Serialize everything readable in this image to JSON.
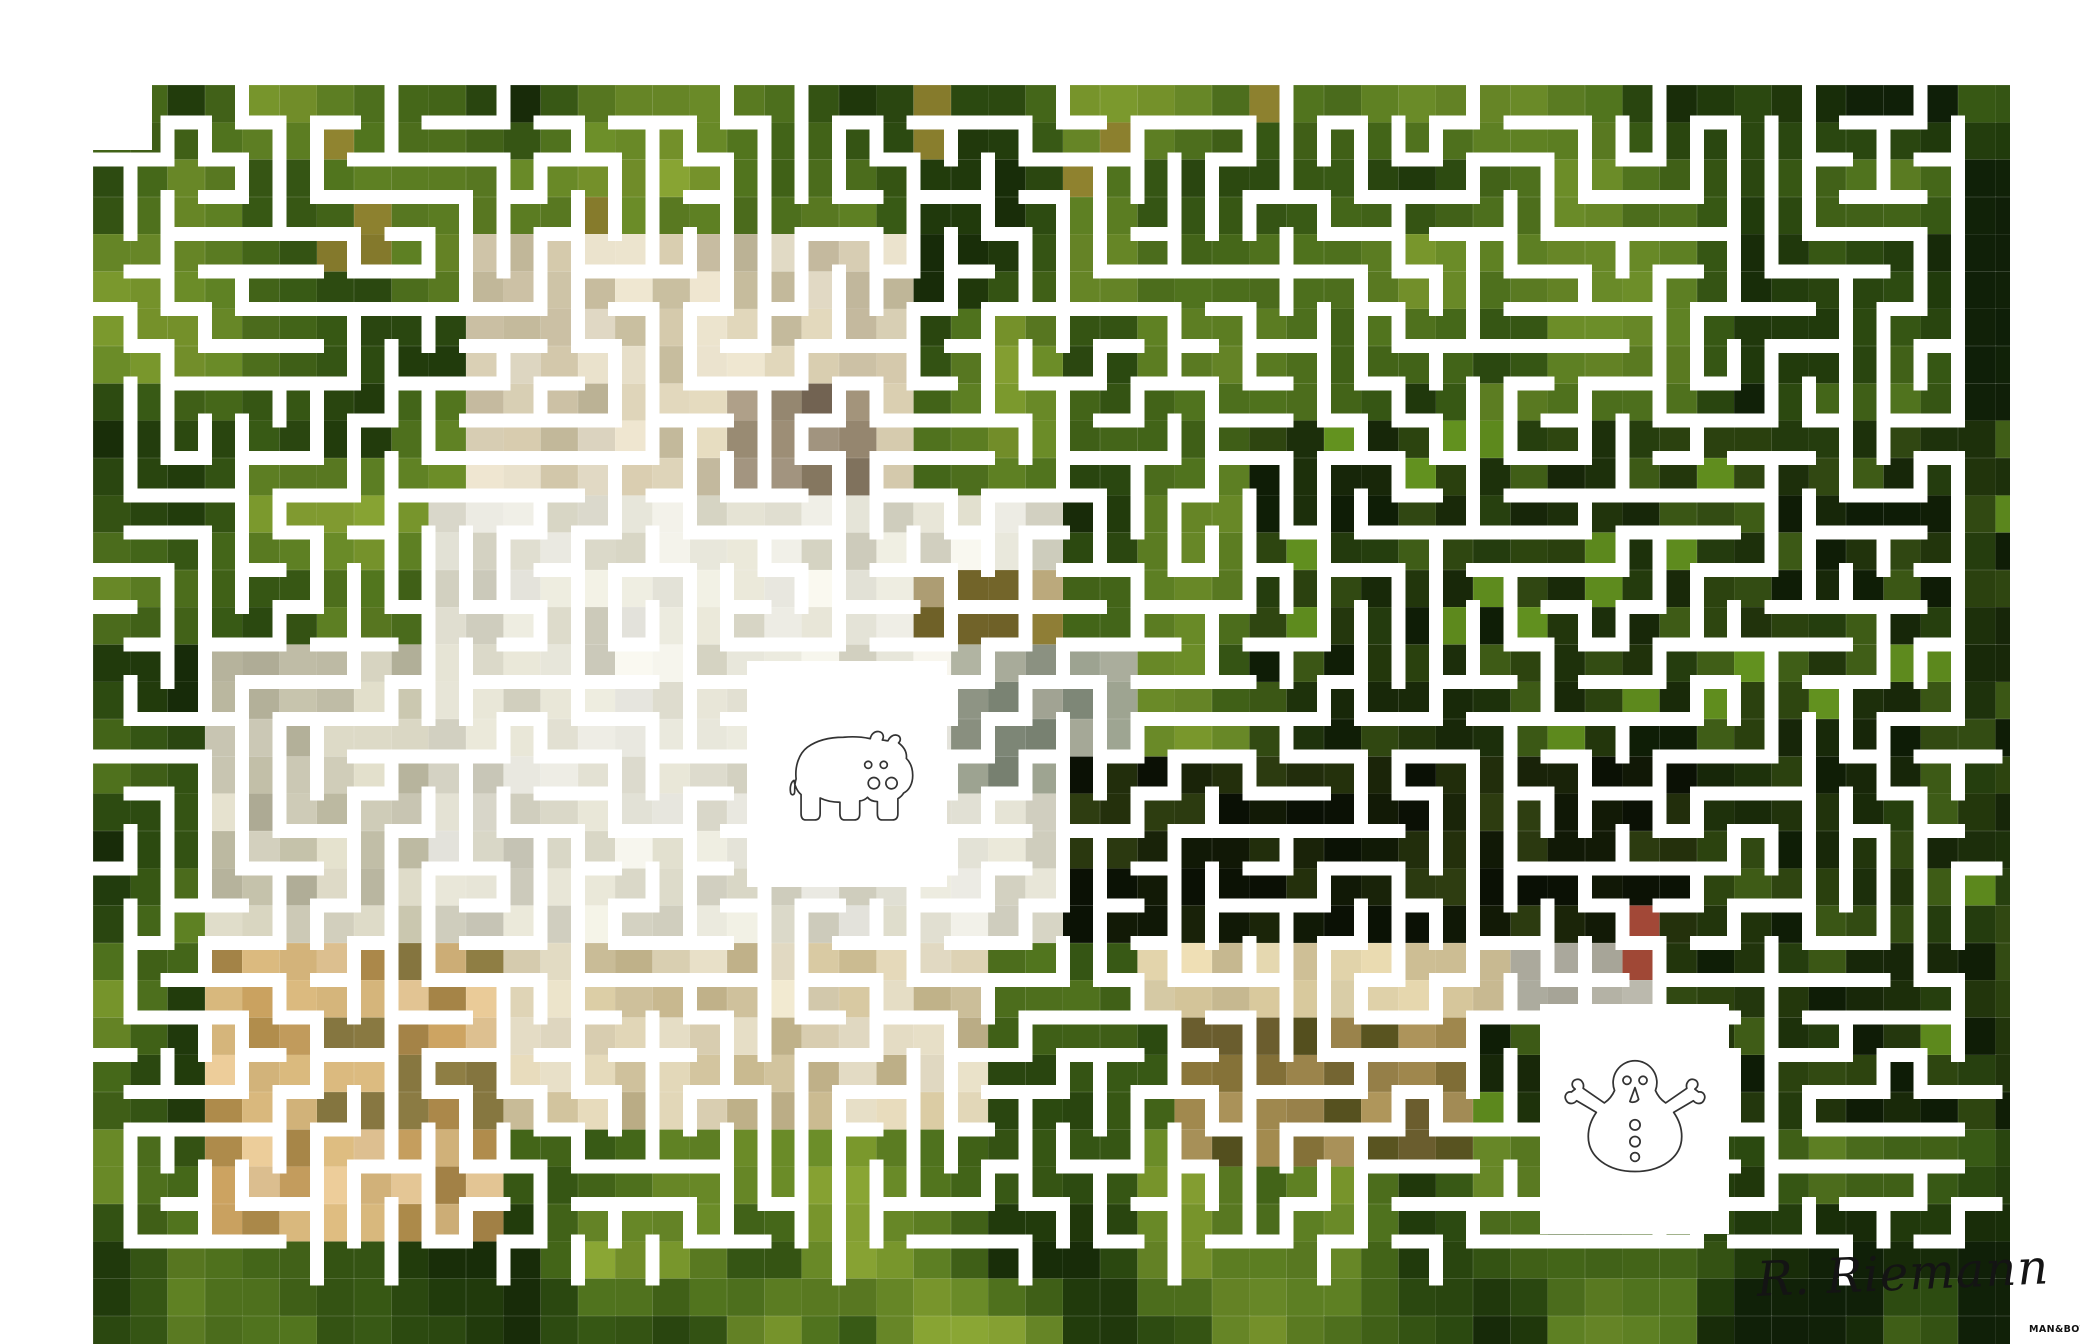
{
  "page": {
    "background": "#ffffff"
  },
  "maze": {
    "origin_x": 93,
    "origin_y": 85,
    "pitch": 37.3,
    "grid_cols": 51,
    "grid_rows": 32,
    "mosaic_cols": 52,
    "mosaic_rows": 34,
    "mosaic_width": 1917,
    "mosaic_height": 1259,
    "wall_thickness": 14,
    "wall_color": "#ffffff",
    "seed": 42,
    "cell_seam_color": "rgba(255,255,255,0.16)",
    "entrance_notch": {
      "x": 93,
      "y": 85,
      "w": 59,
      "h": 65
    }
  },
  "photo": {
    "grass_palette": [
      "#85a032",
      "#76932b",
      "#688827",
      "#5b7c22",
      "#4e701d",
      "#426318",
      "#365614",
      "#2b4810",
      "#213a0c",
      "#182c09",
      "#102008"
    ],
    "gold_accent": "#8b7f2e",
    "patches": [
      {
        "name": "dark-right-field",
        "c0": 31,
        "c1": 52,
        "r0": 9,
        "r1": 28,
        "colors": [
          "#2c430f",
          "#22350c",
          "#182809",
          "#314912",
          "#0f1d06",
          "#3d5a16",
          "#253d0e",
          "#5f8c1e",
          "#1d300b"
        ]
      },
      {
        "name": "head-cream",
        "c0": 10,
        "c1": 22,
        "r0": 4,
        "r1": 11,
        "colors": [
          "#ded4b9",
          "#e5ddc8",
          "#d4c9ac",
          "#cbc0a4",
          "#c2b89a"
        ]
      },
      {
        "name": "muzzle-brown",
        "c0": 17,
        "c1": 21,
        "r0": 8,
        "r1": 11,
        "colors": [
          "#9c8d75",
          "#83755f",
          "#6f6150",
          "#a89a84"
        ]
      },
      {
        "name": "body-white",
        "c0": 9,
        "c1": 26,
        "r0": 11,
        "r1": 23,
        "colors": [
          "#eae9dd",
          "#e2e0d2",
          "#d8d6c6",
          "#efeee6",
          "#cfcdbd"
        ]
      },
      {
        "name": "body-left",
        "c0": 3,
        "c1": 9,
        "r0": 15,
        "r1": 23,
        "colors": [
          "#dcd9c6",
          "#cfccb8",
          "#c2bfa8",
          "#b5b29b"
        ]
      },
      {
        "name": "olive-brown-mid",
        "c0": 22,
        "c1": 26,
        "r0": 13,
        "r1": 15,
        "colors": [
          "#8a7a34",
          "#6f6128",
          "#5e5524",
          "#b5a478"
        ]
      },
      {
        "name": "gray-shoulder",
        "c0": 23,
        "c1": 28,
        "r0": 15,
        "r1": 19,
        "colors": [
          "#a9ac9b",
          "#9aa08e",
          "#8a9080",
          "#798272"
        ]
      },
      {
        "name": "dark-shadow-core",
        "c0": 26,
        "c1": 43,
        "r0": 18,
        "r1": 23,
        "colors": [
          "#1a2409",
          "#111906",
          "#232f0c",
          "#2c3b10",
          "#0b1105"
        ]
      },
      {
        "name": "bottom-cream-band",
        "c0": 9,
        "c1": 24,
        "r0": 23,
        "r1": 28,
        "colors": [
          "#e8e0c8",
          "#ddd2b4",
          "#d2c49e",
          "#c4b58c"
        ]
      },
      {
        "name": "legs-tan",
        "c0": 3,
        "c1": 11,
        "r0": 23,
        "r1": 31,
        "colors": [
          "#e2c493",
          "#d6b67c",
          "#c59e5e",
          "#a98749",
          "#8a7a42"
        ]
      },
      {
        "name": "beige-band-right",
        "c0": 28,
        "c1": 38,
        "r0": 23,
        "r1": 25,
        "colors": [
          "#ded1ab",
          "#e6d7ae",
          "#cfc096"
        ]
      },
      {
        "name": "gray-cells-right",
        "c0": 38,
        "c1": 42,
        "r0": 23,
        "r1": 25,
        "colors": [
          "#b2b0a3",
          "#a6a497",
          "#c4c2b6"
        ]
      },
      {
        "name": "olive-tan-lower",
        "c0": 29,
        "c1": 37,
        "r0": 25,
        "r1": 29,
        "colors": [
          "#9c854c",
          "#857238",
          "#6f6130",
          "#56511f",
          "#a89058"
        ]
      },
      {
        "name": "red-accent-cell",
        "c0": 41,
        "c1": 42,
        "r0": 22,
        "r1": 24,
        "colors": [
          "#a34937",
          "#97422f"
        ]
      }
    ]
  },
  "markers": {
    "icon_stroke": "#333333",
    "start": {
      "icon": "hippo",
      "box": {
        "x": 747,
        "y": 661,
        "w": 200,
        "h": 226
      }
    },
    "end": {
      "icon": "snowman",
      "box": {
        "x": 1540,
        "y": 1004,
        "w": 189,
        "h": 230
      }
    }
  },
  "signature": {
    "text": "R. Riemann",
    "color": "#141414",
    "x": 1758,
    "y": 1252,
    "size": 48,
    "rotate": -2.5
  },
  "watermark": {
    "text": "MAN&BOT",
    "color": "#111111",
    "x": 2029,
    "y": 1324,
    "size": 9.5
  }
}
